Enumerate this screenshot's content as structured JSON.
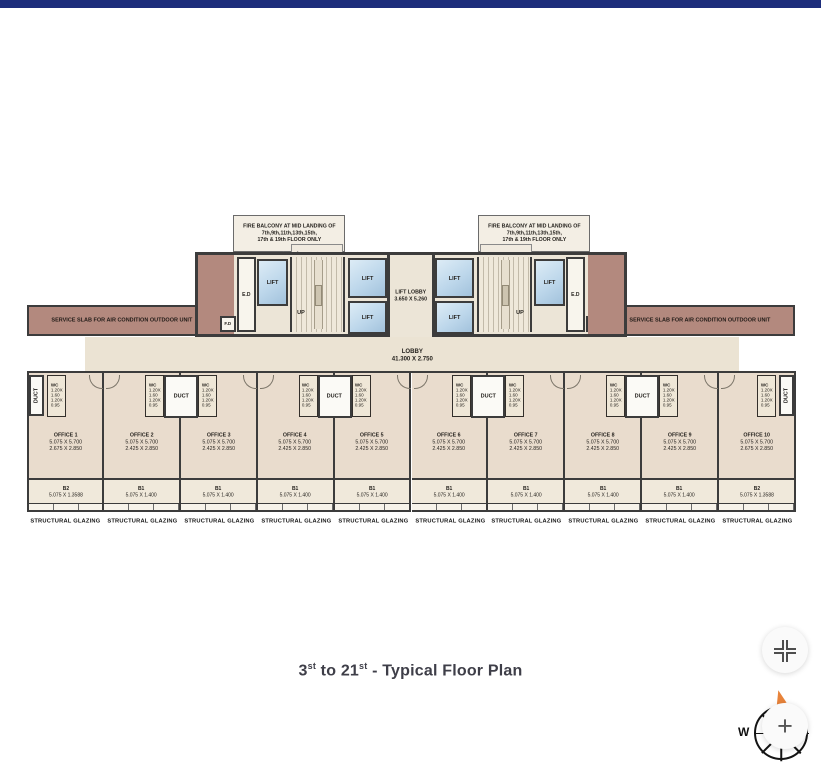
{
  "colors": {
    "top_bar": "#1d2d7b",
    "wall": "#3c3c3c",
    "office_floor": "#e9dccd",
    "core_floor": "#ece5d7",
    "lobby_floor": "#ebe3d3",
    "balcony_floor": "#f0e9db",
    "service_slab": "#b3897e",
    "lift_fill": "#bdd7eb",
    "compass_needle": "#e8833a",
    "caption_text": "#3e3e48"
  },
  "plan": {
    "fire_note_lines": [
      "FIRE BALCONY AT MID LANDING OF",
      "7th,9th,11th,13th,15th,",
      "17th & 19th FLOOR ONLY"
    ],
    "labels": {
      "service_slab": "SERVICE SLAB FOR AIR CONDITION OUTDOOR UNIT",
      "lift": "LIFT",
      "ed": "E.D",
      "fd": "F.D",
      "up": "UP",
      "duct": "DUCT",
      "lift_lobby_name": "LIFT LOBBY",
      "lift_lobby_dims": "3.650 X 5.260",
      "lobby_name": "LOBBY",
      "lobby_dims": "41.300 X 2.750",
      "wc_name": "WC",
      "wc_dims": [
        "1.20X",
        "1.60",
        "1.20X",
        "0.95"
      ],
      "structural_glazing": "STRUCTURAL GLAZING"
    },
    "offices": [
      {
        "name": "OFFICE 1",
        "dim1": "5.075 X 5.700",
        "dim2": "2.675 X 2.850",
        "balcony": "B2",
        "balcony_dim": "5.075 X 1.3588"
      },
      {
        "name": "OFFICE 2",
        "dim1": "5.075 X 5.700",
        "dim2": "2.425 X 2.850",
        "balcony": "B1",
        "balcony_dim": "5.075 X 1.400"
      },
      {
        "name": "OFFICE 3",
        "dim1": "5.075 X 5.700",
        "dim2": "2.425 X 2.850",
        "balcony": "B1",
        "balcony_dim": "5.075 X 1.400"
      },
      {
        "name": "OFFICE 4",
        "dim1": "5.075 X 5.700",
        "dim2": "2.425 X 2.850",
        "balcony": "B1",
        "balcony_dim": "5.075 X 1.400"
      },
      {
        "name": "OFFICE 5",
        "dim1": "5.075 X 5.700",
        "dim2": "2.425 X 2.850",
        "balcony": "B1",
        "balcony_dim": "5.075 X 1.400"
      },
      {
        "name": "OFFICE 6",
        "dim1": "5.075 X 5.700",
        "dim2": "2.425 X 2.850",
        "balcony": "B1",
        "balcony_dim": "5.075 X 1.400"
      },
      {
        "name": "OFFICE 7",
        "dim1": "5.075 X 5.700",
        "dim2": "2.425 X 2.850",
        "balcony": "B1",
        "balcony_dim": "5.075 X 1.400"
      },
      {
        "name": "OFFICE 8",
        "dim1": "5.075 X 5.700",
        "dim2": "2.425 X 2.850",
        "balcony": "B1",
        "balcony_dim": "5.075 X 1.400"
      },
      {
        "name": "OFFICE 9",
        "dim1": "5.075 X 5.700",
        "dim2": "2.425 X 2.850",
        "balcony": "B1",
        "balcony_dim": "5.075 X 1.400"
      },
      {
        "name": "OFFICE 10",
        "dim1": "5.075 X 5.700",
        "dim2": "2.675 X 2.850",
        "balcony": "B2",
        "balcony_dim": "5.075 X 1.3588"
      }
    ]
  },
  "caption": {
    "start_num": "3",
    "start_sup": "st",
    "to_num": " to 21",
    "end_sup": "st",
    "rest": " - Typical Floor Plan"
  },
  "controls": {
    "zoom_in_glyph": "+",
    "compass_west": "W"
  }
}
